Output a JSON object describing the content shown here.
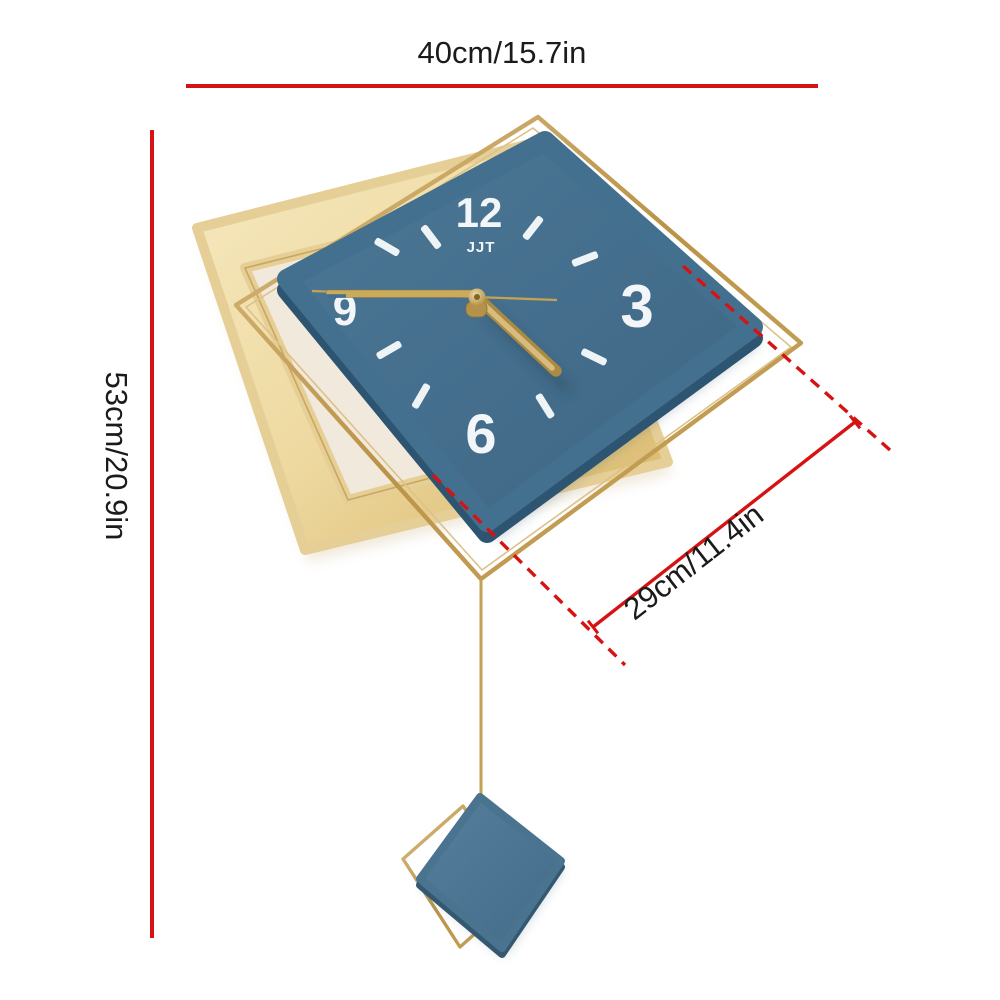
{
  "image_type": "wall clock product dimension diagram",
  "annotations": {
    "width": {
      "label": "40cm/15.7in"
    },
    "height": {
      "label": "53cm/20.9in"
    },
    "face_width": {
      "label": "29cm/11.4in"
    },
    "line_color": "#d61313",
    "text_color": "#1b1b1b"
  },
  "clock": {
    "brand": "JJT",
    "numerals": {
      "twelve": "12",
      "three": "3",
      "six": "6",
      "nine": "9"
    },
    "hour_tick_count": 8,
    "time_shown": "approx. 4:45",
    "colors": {
      "face_blue": "#44708f",
      "face_side_blue": "#2d5470",
      "panel_gold_light": "#f4e5b8",
      "panel_gold_dark": "#d9b96a",
      "wire_gold": "#bf9a4e",
      "hands_gold": "#c8a857",
      "numeral_white": "#f2f6f8",
      "background": "#ffffff"
    }
  }
}
